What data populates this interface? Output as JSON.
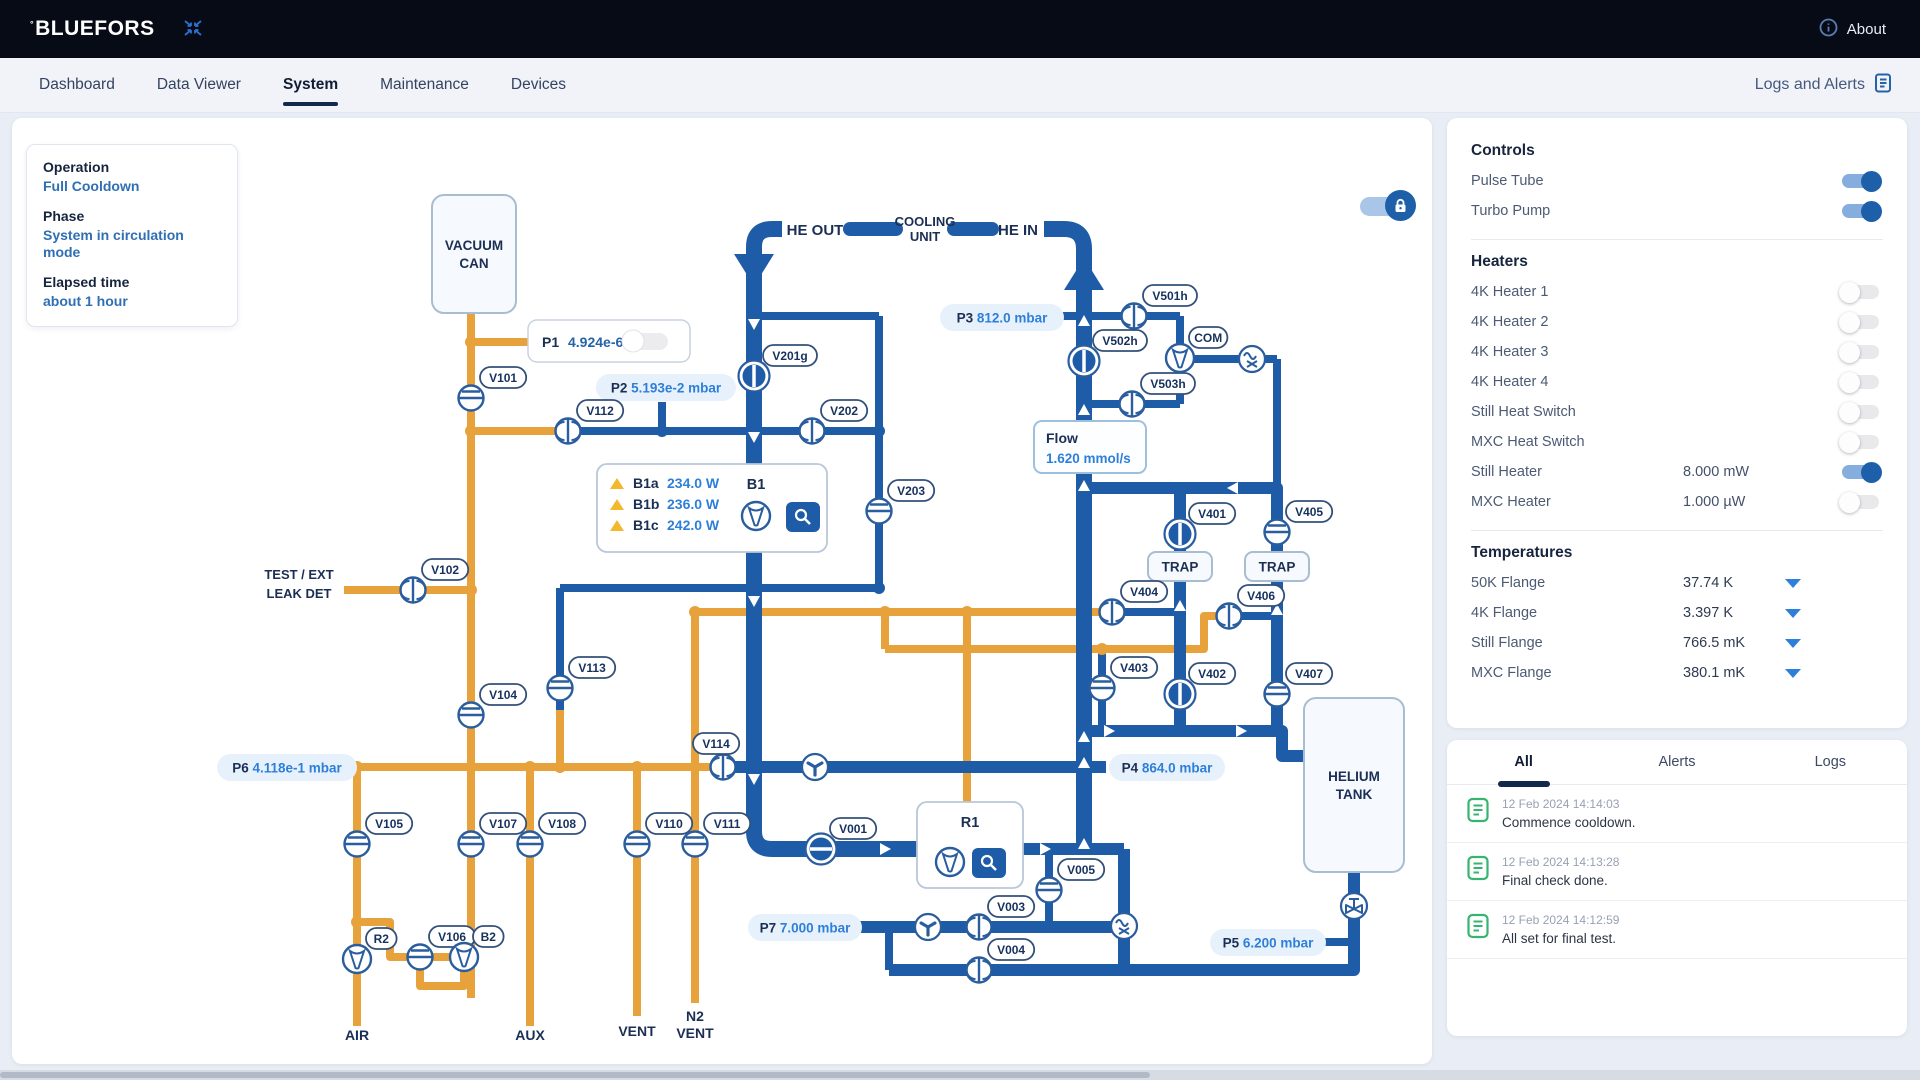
{
  "topbar": {
    "brand": "BLUEFORS",
    "about": "About"
  },
  "nav": {
    "tabs": [
      {
        "label": "Dashboard",
        "active": false
      },
      {
        "label": "Data Viewer",
        "active": false
      },
      {
        "label": "System",
        "active": true
      },
      {
        "label": "Maintenance",
        "active": false
      },
      {
        "label": "Devices",
        "active": false
      }
    ],
    "logs_link": "Logs and Alerts"
  },
  "status_card": {
    "operation_label": "Operation",
    "operation": "Full Cooldown",
    "phase_label": "Phase",
    "phase": "System in circulation mode",
    "elapsed_label": "Elapsed time",
    "elapsed": "about 1 hour"
  },
  "controls": {
    "title": "Controls",
    "switches": [
      {
        "label": "Pulse Tube",
        "on": true
      },
      {
        "label": "Turbo Pump",
        "on": true
      }
    ]
  },
  "heaters": {
    "title": "Heaters",
    "rows": [
      {
        "label": "4K Heater 1",
        "value": "",
        "on": false
      },
      {
        "label": "4K Heater 2",
        "value": "",
        "on": false
      },
      {
        "label": "4K Heater 3",
        "value": "",
        "on": false
      },
      {
        "label": "4K Heater 4",
        "value": "",
        "on": false
      },
      {
        "label": "Still Heat Switch",
        "value": "",
        "on": false
      },
      {
        "label": "MXC Heat Switch",
        "value": "",
        "on": false
      },
      {
        "label": "Still Heater",
        "value": "8.000 mW",
        "on": true
      },
      {
        "label": "MXC Heater",
        "value": "1.000 µW",
        "on": false
      }
    ]
  },
  "temperatures": {
    "title": "Temperatures",
    "rows": [
      {
        "label": "50K Flange",
        "value": "37.74 K"
      },
      {
        "label": "4K Flange",
        "value": "3.397 K"
      },
      {
        "label": "Still Flange",
        "value": "766.5 mK"
      },
      {
        "label": "MXC Flange",
        "value": "380.1 mK"
      }
    ]
  },
  "logs": {
    "tabs": [
      "All",
      "Alerts",
      "Logs"
    ],
    "active": "All",
    "entries": [
      {
        "ts": "12 Feb 2024 14:14:03",
        "msg": "Commence cooldown."
      },
      {
        "ts": "12 Feb 2024 14:13:28",
        "msg": "Final check done."
      },
      {
        "ts": "12 Feb 2024 14:12:59",
        "msg": "All set for final test."
      }
    ]
  },
  "diagram": {
    "colors": {
      "orange": "#E8A23B",
      "blue": "#1E5CA8",
      "navy": "#1b2f55",
      "value_blue": "#2e7fd9"
    },
    "pipes": [
      {
        "t": "o",
        "d": "M459,196 L459,649"
      },
      {
        "t": "o",
        "d": "M459,224 L520,224"
      },
      {
        "t": "o",
        "d": "M332,472 L459,472"
      },
      {
        "t": "o",
        "d": "M459,313 L556,313"
      },
      {
        "t": "o",
        "d": "M340,649 L711,649"
      },
      {
        "t": "o",
        "d": "M683,494 L1100,494"
      },
      {
        "t": "o",
        "d": "M683,494 L683,885"
      },
      {
        "t": "o",
        "d": "M873,494 L873,531"
      },
      {
        "t": "o",
        "d": "M873,531 L1192,531 L1192,498 L1217,498"
      },
      {
        "t": "o",
        "d": "M955,494 L955,684"
      },
      {
        "t": "o",
        "d": "M345,649 L345,908"
      },
      {
        "t": "o",
        "d": "M345,804 L378,804 L378,839 L459,839"
      },
      {
        "t": "o",
        "d": "M408,852 L408,868 L452,868 L452,852"
      },
      {
        "t": "o",
        "d": "M459,649 L459,880"
      },
      {
        "t": "o",
        "d": "M518,649 L518,908"
      },
      {
        "t": "o",
        "d": "M625,649 L625,898"
      },
      {
        "t": "o",
        "d": "M548,592 L548,649"
      },
      {
        "t": "b",
        "d": "M556,313 L867,313"
      },
      {
        "t": "b",
        "d": "M650,284 L650,313"
      },
      {
        "t": "b",
        "d": "M867,198 L867,470"
      },
      {
        "t": "b",
        "d": "M742,198 L867,198"
      },
      {
        "t": "b",
        "d": "M548,470 L867,470"
      },
      {
        "t": "b",
        "d": "M548,470 L548,592"
      },
      {
        "t": "b",
        "d": "M1050,198 L1072,198"
      },
      {
        "t": "b",
        "d": "M1072,198 L1168,198"
      },
      {
        "t": "b",
        "d": "M1168,198 L1168,286"
      },
      {
        "t": "b",
        "d": "M1072,286 L1168,286"
      },
      {
        "t": "b",
        "d": "M1168,241 L1265,241"
      },
      {
        "t": "b",
        "d": "M1265,241 L1265,370"
      },
      {
        "t": "b",
        "d": "M1100,494 L1168,494"
      },
      {
        "t": "b",
        "d": "M1217,498 L1265,498"
      },
      {
        "t": "b",
        "d": "M1090,531 L1090,613"
      },
      {
        "t": "b",
        "d": "M1037,731 L1037,809"
      },
      {
        "t": "b",
        "d": "M877,809 L877,852"
      },
      {
        "t": "b",
        "d": "M1312,824 L1342,824"
      },
      {
        "t": "m",
        "d": "M1072,370 L1265,370"
      },
      {
        "t": "m",
        "d": "M1168,370 L1168,613"
      },
      {
        "t": "m",
        "d": "M1265,370 L1265,613"
      },
      {
        "t": "m",
        "d": "M1072,613 L1270,613 L1270,638 L1292,638"
      },
      {
        "t": "m",
        "d": "M711,649 L1072,649"
      },
      {
        "t": "m",
        "d": "M1072,649 L1094,649"
      },
      {
        "t": "m",
        "d": "M1011,731 L1112,731"
      },
      {
        "t": "m",
        "d": "M1112,731 L1112,852"
      },
      {
        "t": "m",
        "d": "M848,809 L1112,809"
      },
      {
        "t": "m",
        "d": "M877,852 L1342,852 L1342,754"
      },
      {
        "t": "t",
        "d": "M770,111 L760,111 Q742,111 742,129 L742,713 Q742,731 760,731 L905,731"
      },
      {
        "t": "t",
        "d": "M1032,111 L1052,111 Q1072,111 1072,131 L1072,731"
      },
      {
        "t": "cap",
        "d": "M838,111 L884,111"
      },
      {
        "t": "cap",
        "d": "M942,111 L980,111"
      }
    ],
    "dots": [
      {
        "c": "o",
        "x": 459,
        "y": 224
      },
      {
        "c": "o",
        "x": 459,
        "y": 313
      },
      {
        "c": "o",
        "x": 459,
        "y": 472
      },
      {
        "c": "o",
        "x": 459,
        "y": 649
      },
      {
        "c": "o",
        "x": 345,
        "y": 649
      },
      {
        "c": "o",
        "x": 345,
        "y": 804
      },
      {
        "c": "o",
        "x": 518,
        "y": 649
      },
      {
        "c": "o",
        "x": 548,
        "y": 649
      },
      {
        "c": "o",
        "x": 625,
        "y": 649
      },
      {
        "c": "o",
        "x": 683,
        "y": 494
      },
      {
        "c": "o",
        "x": 683,
        "y": 649
      },
      {
        "c": "o",
        "x": 873,
        "y": 494
      },
      {
        "c": "o",
        "x": 955,
        "y": 494
      },
      {
        "c": "o",
        "x": 955,
        "y": 531
      },
      {
        "c": "o",
        "x": 1090,
        "y": 531
      },
      {
        "c": "b",
        "x": 650,
        "y": 313
      },
      {
        "c": "b",
        "x": 742,
        "y": 198
      },
      {
        "c": "b",
        "x": 742,
        "y": 313
      },
      {
        "c": "b",
        "x": 742,
        "y": 649
      },
      {
        "c": "b",
        "x": 867,
        "y": 313
      },
      {
        "c": "b",
        "x": 867,
        "y": 470
      },
      {
        "c": "b",
        "x": 1168,
        "y": 370
      },
      {
        "c": "b",
        "x": 1168,
        "y": 494
      },
      {
        "c": "b",
        "x": 1168,
        "y": 613
      },
      {
        "c": "b",
        "x": 1265,
        "y": 370
      },
      {
        "c": "b",
        "x": 1265,
        "y": 498
      },
      {
        "c": "b",
        "x": 1265,
        "y": 613
      },
      {
        "c": "b",
        "x": 1037,
        "y": 731
      },
      {
        "c": "b",
        "x": 1037,
        "y": 809
      },
      {
        "c": "b",
        "x": 877,
        "y": 809
      },
      {
        "c": "b",
        "x": 1112,
        "y": 852
      },
      {
        "c": "b",
        "x": 1342,
        "y": 824
      },
      {
        "c": "b",
        "x": 1072,
        "y": 613
      },
      {
        "c": "b",
        "x": 1072,
        "y": 649
      }
    ],
    "arrows": [
      {
        "t": "flare-down",
        "x": 742,
        "y": 136
      },
      {
        "t": "flare-up",
        "x": 1072,
        "y": 172
      },
      {
        "t": "wd",
        "x": 742,
        "y": 205
      },
      {
        "t": "wd",
        "x": 742,
        "y": 318
      },
      {
        "t": "wd",
        "x": 742,
        "y": 482
      },
      {
        "t": "wd",
        "x": 742,
        "y": 660
      },
      {
        "t": "wu",
        "x": 1072,
        "y": 204
      },
      {
        "t": "wu",
        "x": 1072,
        "y": 293
      },
      {
        "t": "wu",
        "x": 1072,
        "y": 369
      },
      {
        "t": "wu",
        "x": 1072,
        "y": 620
      },
      {
        "t": "wu",
        "x": 1072,
        "y": 646
      },
      {
        "t": "wu",
        "x": 1072,
        "y": 727
      },
      {
        "t": "wu",
        "x": 1168,
        "y": 489
      },
      {
        "t": "wu",
        "x": 1265,
        "y": 493
      },
      {
        "t": "wr",
        "x": 872,
        "y": 731
      },
      {
        "t": "wr",
        "x": 1032,
        "y": 731
      },
      {
        "t": "wr",
        "x": 1096,
        "y": 613
      },
      {
        "t": "wr",
        "x": 1228,
        "y": 613
      },
      {
        "t": "wl",
        "x": 1222,
        "y": 370
      }
    ],
    "gauges": [
      {
        "id": "P2",
        "label": "P2",
        "value": "5.193e-2 mbar",
        "x": 584,
        "y": 256,
        "w": 140
      },
      {
        "id": "P3",
        "label": "P3",
        "value": "812.0 mbar",
        "x": 928,
        "y": 186,
        "w": 124
      },
      {
        "id": "P4",
        "label": "P4",
        "value": "864.0 mbar",
        "x": 1097,
        "y": 636,
        "w": 116
      },
      {
        "id": "P5",
        "label": "P5",
        "value": "6.200 mbar",
        "x": 1198,
        "y": 811,
        "w": 116
      },
      {
        "id": "P6",
        "label": "P6",
        "value": "4.118e-1 mbar",
        "x": 205,
        "y": 636,
        "w": 140
      },
      {
        "id": "P7",
        "label": "P7",
        "value": "7.000 mbar",
        "x": 736,
        "y": 796,
        "w": 114
      }
    ],
    "boxes": [
      {
        "id": "vacuum-can",
        "x": 420,
        "y": 77,
        "w": 84,
        "h": 118,
        "lines": [
          "VACUUM",
          "CAN"
        ]
      },
      {
        "id": "helium-tank",
        "x": 1292,
        "y": 580,
        "w": 100,
        "h": 174,
        "lines": [
          "HELIUM",
          "TANK"
        ]
      },
      {
        "id": "trap-1",
        "x": 1136,
        "y": 434,
        "w": 64,
        "h": 29,
        "lines": [
          "TRAP"
        ]
      },
      {
        "id": "trap-2",
        "x": 1233,
        "y": 434,
        "w": 64,
        "h": 29,
        "lines": [
          "TRAP"
        ]
      }
    ],
    "flow_box": {
      "x": 1022,
      "y": 303,
      "w": 112,
      "h": 52,
      "label": "Flow",
      "value": "1.620 mmol/s"
    },
    "p1": {
      "x": 516,
      "y": 202,
      "w": 162,
      "h": 42,
      "label": "P1",
      "value": "4.924e-6 mbar"
    },
    "b1": {
      "x": 585,
      "y": 346,
      "w": 230,
      "h": 88,
      "title": "B1",
      "rows": [
        {
          "id": "B1a",
          "value": "234.0 W"
        },
        {
          "id": "B1b",
          "value": "236.0 W"
        },
        {
          "id": "B1c",
          "value": "242.0 W"
        }
      ]
    },
    "r1": {
      "x": 905,
      "y": 684,
      "w": 106,
      "h": 86,
      "title": "R1"
    },
    "valves": [
      {
        "id": "V101",
        "x": 459,
        "y": 280,
        "t": "gate"
      },
      {
        "id": "V102",
        "x": 401,
        "y": 472,
        "t": "bfly"
      },
      {
        "id": "V104",
        "x": 459,
        "y": 597,
        "t": "gate"
      },
      {
        "id": "V105",
        "x": 345,
        "y": 726,
        "t": "gate"
      },
      {
        "id": "V106",
        "x": 408,
        "y": 839,
        "t": "gate"
      },
      {
        "id": "V107",
        "x": 459,
        "y": 726,
        "t": "gate"
      },
      {
        "id": "V108",
        "x": 518,
        "y": 726,
        "t": "gate"
      },
      {
        "id": "V110",
        "x": 625,
        "y": 726,
        "t": "gate"
      },
      {
        "id": "V111",
        "x": 683,
        "y": 726,
        "t": "gate"
      },
      {
        "id": "V112",
        "x": 556,
        "y": 313,
        "t": "bfly"
      },
      {
        "id": "V113",
        "x": 548,
        "y": 570,
        "t": "gate"
      },
      {
        "id": "V114",
        "x": 711,
        "y": 649,
        "t": "bfly",
        "dx": -30,
        "dy": -34
      },
      {
        "id": "V201g",
        "x": 742,
        "y": 258,
        "t": "filled"
      },
      {
        "id": "V202",
        "x": 800,
        "y": 313,
        "t": "bfly"
      },
      {
        "id": "V203",
        "x": 867,
        "y": 393,
        "t": "gate"
      },
      {
        "id": "V401",
        "x": 1168,
        "y": 416,
        "t": "filled"
      },
      {
        "id": "V402",
        "x": 1168,
        "y": 576,
        "t": "filled"
      },
      {
        "id": "V403",
        "x": 1090,
        "y": 570,
        "t": "gate"
      },
      {
        "id": "V404",
        "x": 1100,
        "y": 494,
        "t": "bfly"
      },
      {
        "id": "V405",
        "x": 1265,
        "y": 414,
        "t": "gate"
      },
      {
        "id": "V406",
        "x": 1217,
        "y": 498,
        "t": "bfly"
      },
      {
        "id": "V407",
        "x": 1265,
        "y": 576,
        "t": "gate"
      },
      {
        "id": "V501h",
        "x": 1122,
        "y": 198,
        "t": "bfly"
      },
      {
        "id": "V502h",
        "x": 1072,
        "y": 243,
        "t": "filled"
      },
      {
        "id": "V503h",
        "x": 1120,
        "y": 286,
        "t": "bfly"
      },
      {
        "id": "V001",
        "x": 809,
        "y": 731,
        "t": "filledH"
      },
      {
        "id": "V003",
        "x": 967,
        "y": 809,
        "t": "bfly"
      },
      {
        "id": "V004",
        "x": 967,
        "y": 852,
        "t": "bfly"
      },
      {
        "id": "V005",
        "x": 1037,
        "y": 772,
        "t": "gate"
      },
      {
        "id": "R2",
        "x": 345,
        "y": 841,
        "t": "pump"
      },
      {
        "id": "B2",
        "x": 452,
        "y": 839,
        "t": "pump"
      },
      {
        "id": "COM",
        "x": 1168,
        "y": 240,
        "t": "pump"
      }
    ],
    "icons": [
      {
        "t": "fan",
        "x": 803,
        "y": 649
      },
      {
        "t": "fan",
        "x": 916,
        "y": 809
      },
      {
        "t": "hx",
        "x": 1240,
        "y": 241
      },
      {
        "t": "hx",
        "x": 1112,
        "y": 808
      },
      {
        "t": "bowtie",
        "x": 1342,
        "y": 788
      }
    ],
    "labels": [
      {
        "t": "HE OUT",
        "x": 803,
        "y": 117,
        "s": 15
      },
      {
        "t": "COOLING",
        "x": 913,
        "y": 108,
        "s": 13
      },
      {
        "t": "UNIT",
        "x": 913,
        "y": 123,
        "s": 13
      },
      {
        "t": "HE IN",
        "x": 1006,
        "y": 117,
        "s": 15
      },
      {
        "t": "TEST / EXT",
        "x": 287,
        "y": 461,
        "s": 13
      },
      {
        "t": "LEAK DET",
        "x": 287,
        "y": 480,
        "s": 13
      },
      {
        "t": "AIR",
        "x": 345,
        "y": 922,
        "s": 14
      },
      {
        "t": "AUX",
        "x": 518,
        "y": 922,
        "s": 14
      },
      {
        "t": "VENT",
        "x": 625,
        "y": 918,
        "s": 14
      },
      {
        "t": "N2",
        "x": 683,
        "y": 903,
        "s": 14
      },
      {
        "t": "VENT",
        "x": 683,
        "y": 920,
        "s": 14
      }
    ]
  }
}
